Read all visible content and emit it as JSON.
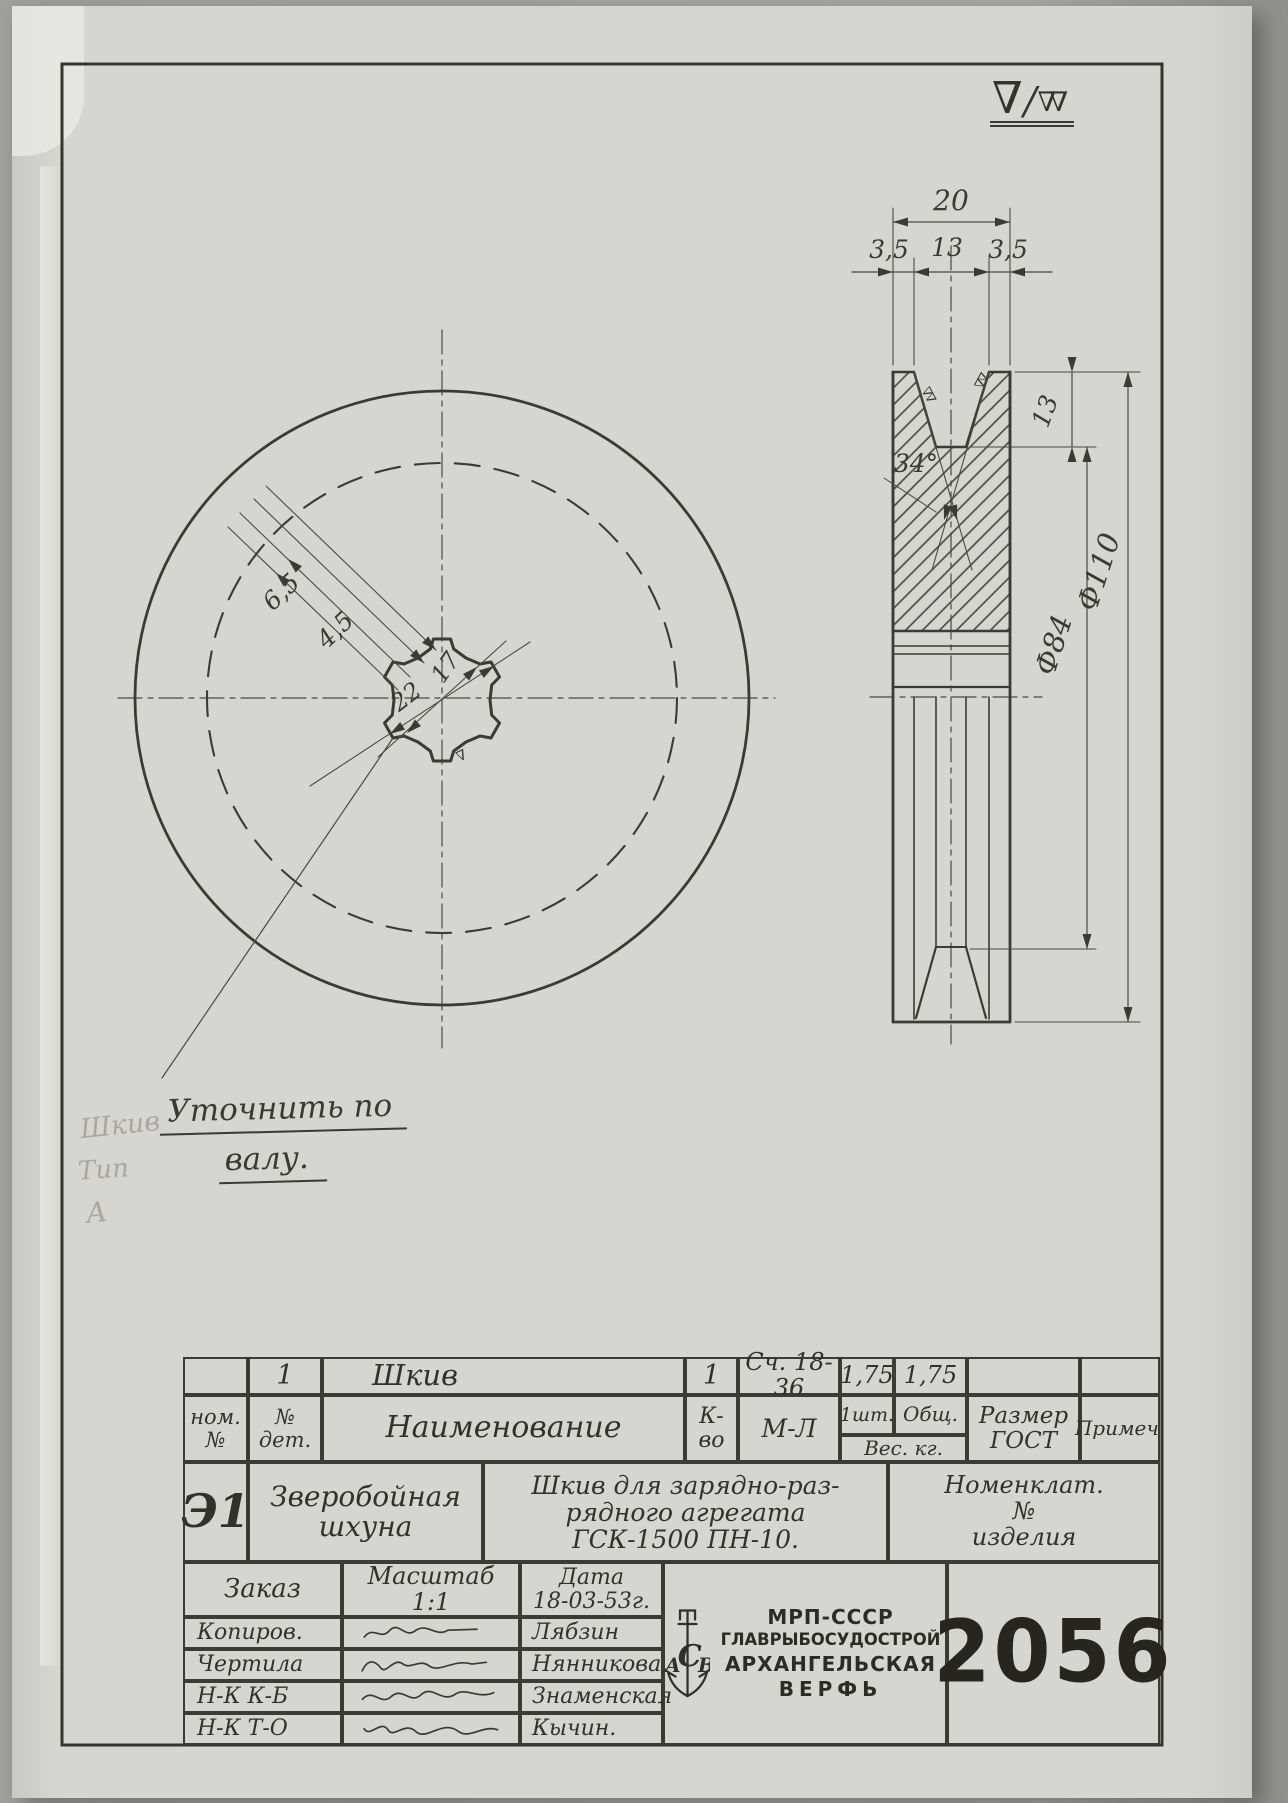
{
  "finish_symbol": {
    "main": "∇",
    "slash": "/",
    "secondary": "∇∇"
  },
  "symbols": {
    "groove_finish": "∇∇",
    "hole_finish": "∇"
  },
  "front_view": {
    "dims": {
      "tooth_outer": "6,5",
      "tooth_inner": "4,5",
      "bore_minor": "17",
      "bore_major": "22"
    },
    "note_line1": "Уточнить по",
    "note_line2": "валу."
  },
  "side_view": {
    "dims": {
      "width": "20",
      "flange_left": "3,5",
      "groove_top": "13",
      "flange_right": "3,5",
      "angle": "34°",
      "groove_depth": "13",
      "groove_bottom_dia": "Ф84",
      "outer_dia": "Ф110"
    }
  },
  "pencil_notes": {
    "n1": "Шкив",
    "n2": "Тип",
    "n3": "А"
  },
  "title_block": {
    "parts_row": {
      "det_no": "1",
      "name": "Шкив",
      "qty": "1",
      "material": "Сч. 18-36",
      "weight_one": "1,75",
      "weight_total": "1,75"
    },
    "header_row": {
      "nom1": "ном.",
      "nom2": "№",
      "det1": "№",
      "det2": "дет.",
      "name": "Наименование",
      "qty": "К-во",
      "material": "М-Л",
      "per_one": "1шт.",
      "total": "Общ.",
      "weight": "Вес. кг.",
      "size1": "Размер",
      "size2": "ГОСТ",
      "remark": "Примеч."
    },
    "project_row": {
      "code": "Э1",
      "object1": "Зверобойная",
      "object2": "шхуна",
      "desc1": "Шкив для зарядно-раз-",
      "desc2": "рядного агрегата",
      "desc3": "ГСК-1500 ПН-10.",
      "nomenclature1": "Номенклат.",
      "nomenclature2": "№",
      "nomenclature3": "изделия"
    },
    "order_row": {
      "order": "Заказ",
      "scale_label": "Масштаб",
      "scale": "1:1",
      "date_label": "Дата",
      "date": "18-03-53г."
    },
    "sig_rows": [
      {
        "role": "Копиров.",
        "name": "Лябзин"
      },
      {
        "role": "Чертила",
        "name": "Нянникова."
      },
      {
        "role": "Н-К К-Б",
        "name": "Знаменская"
      },
      {
        "role": "Н-К Т-О",
        "name": "Кычин."
      }
    ],
    "stamp": {
      "org1": "МРП-СССР",
      "org2": "ГЛАВРЫБОСУДОСТРОЙ",
      "org3": "АРХАНГЕЛЬСКАЯ",
      "org4": "ВЕРФЬ",
      "number": "2056",
      "logo_top": "П",
      "logo_left": "А",
      "logo_center": "С",
      "logo_right": "В"
    }
  }
}
